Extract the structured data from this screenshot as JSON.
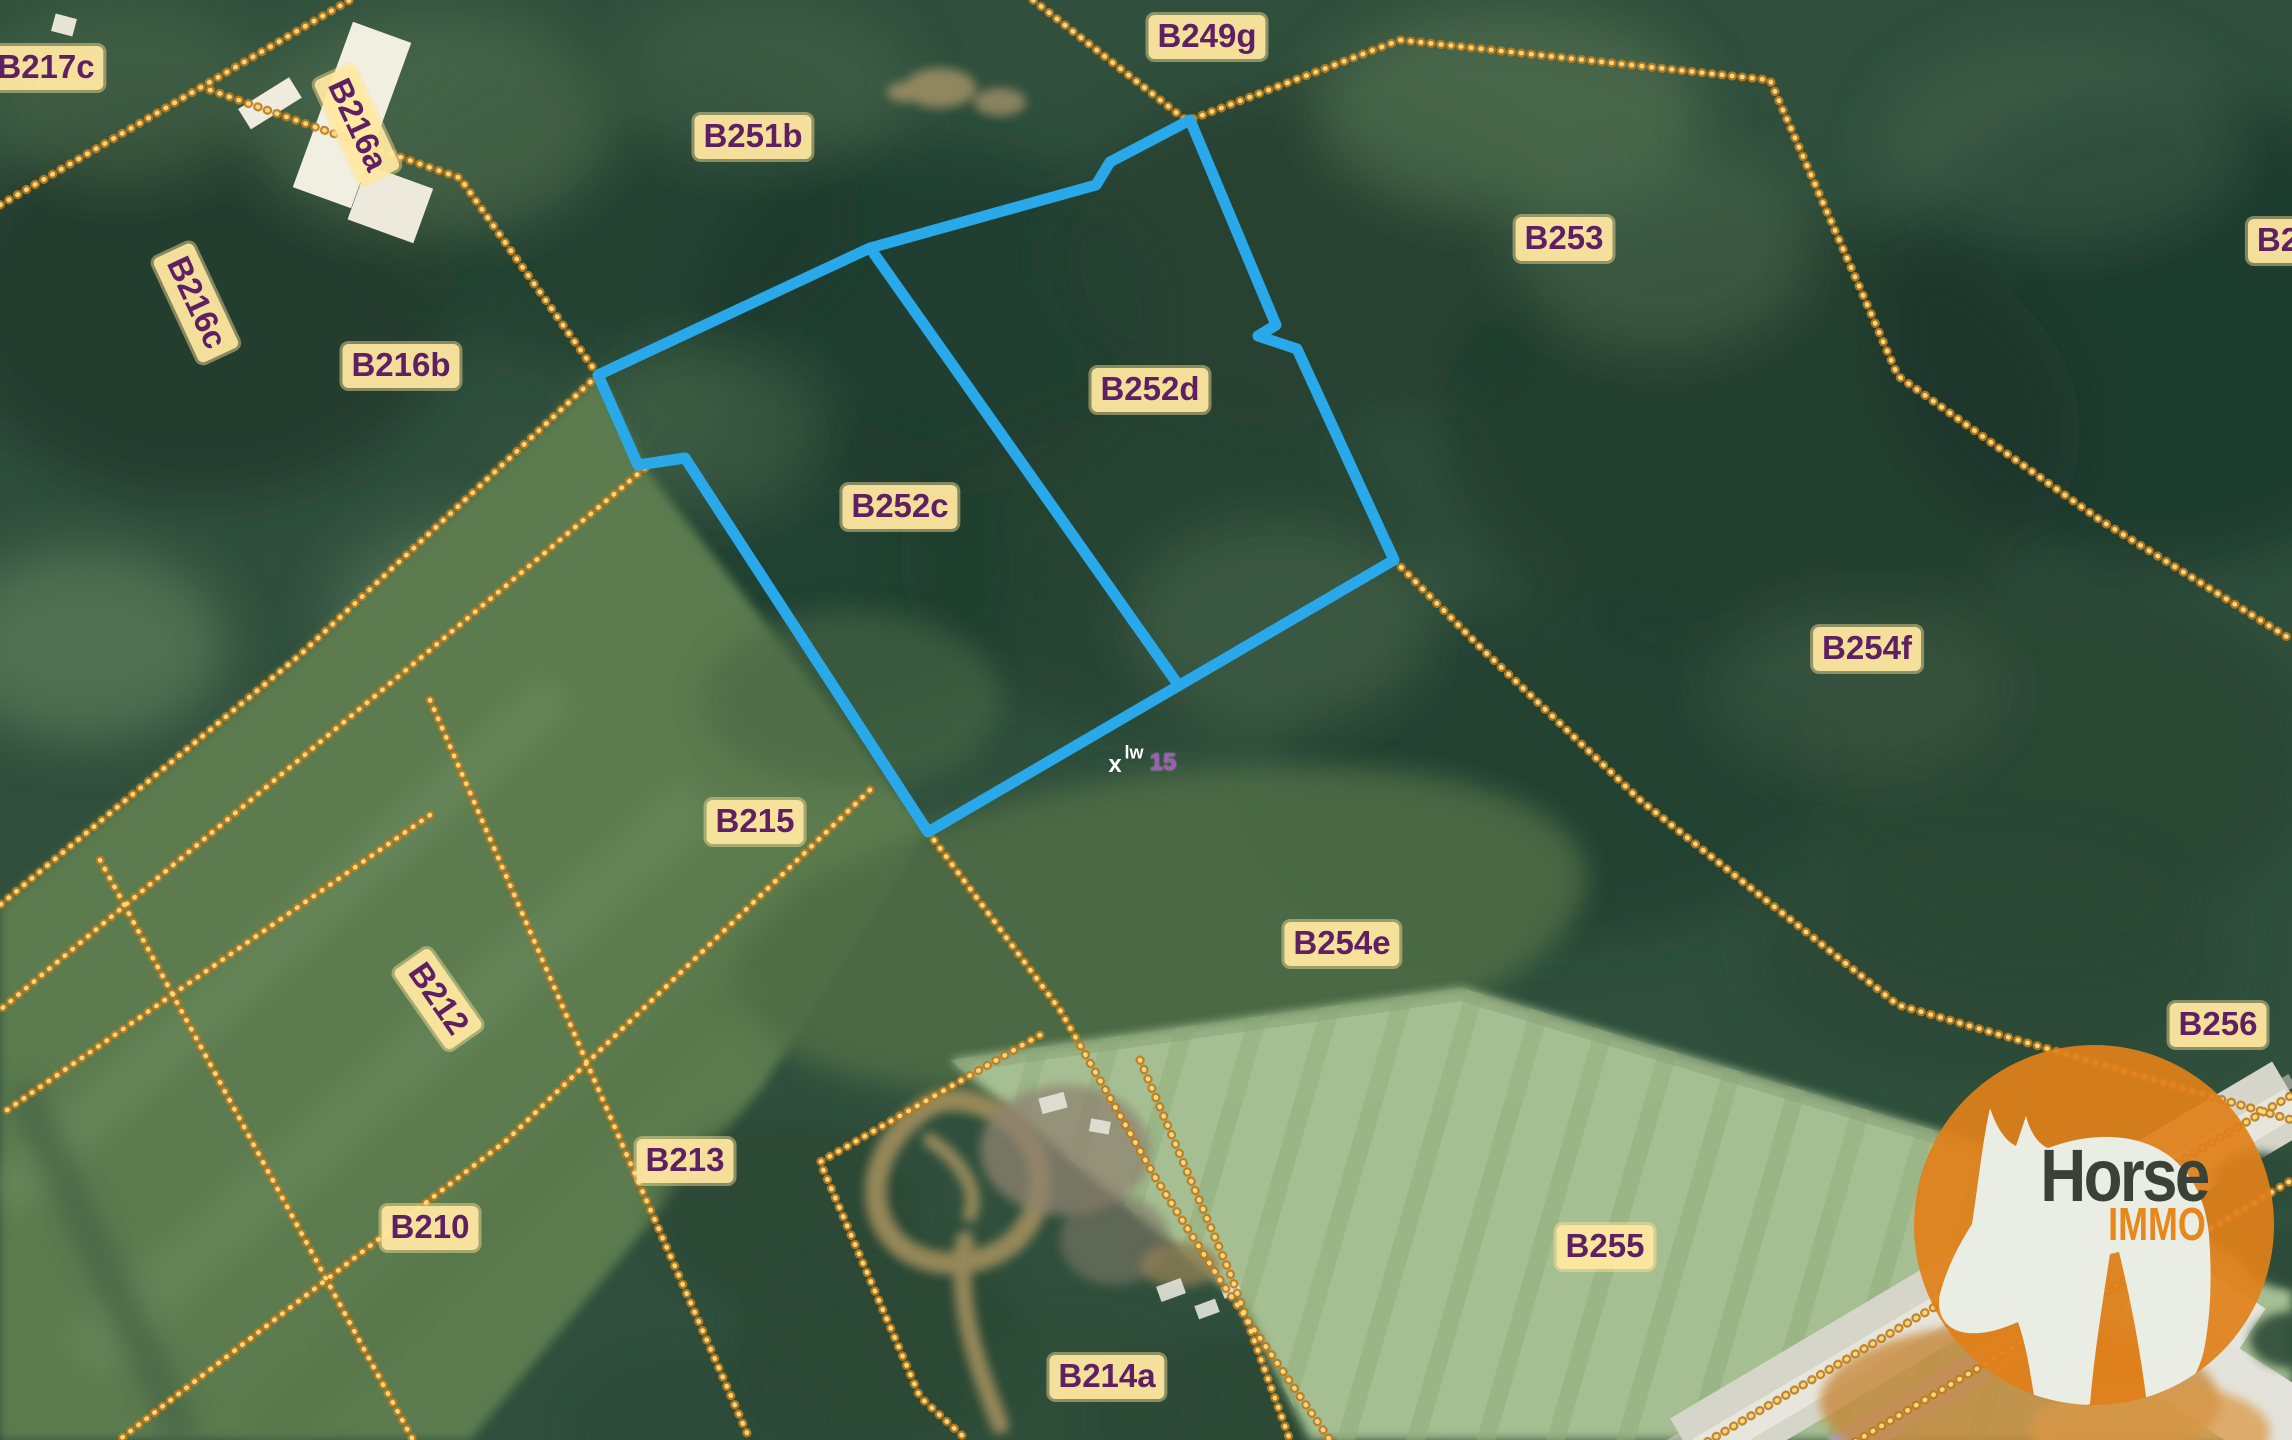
{
  "map": {
    "parcels": [
      {
        "id": "B217c"
      },
      {
        "id": "B216a"
      },
      {
        "id": "B216c"
      },
      {
        "id": "B216b"
      },
      {
        "id": "B251b"
      },
      {
        "id": "B249g"
      },
      {
        "id": "B253"
      },
      {
        "id": "B2"
      },
      {
        "id": "B252d"
      },
      {
        "id": "B252c"
      },
      {
        "id": "B254f"
      },
      {
        "id": "B215"
      },
      {
        "id": "B254e"
      },
      {
        "id": "B212"
      },
      {
        "id": "B213"
      },
      {
        "id": "B210"
      },
      {
        "id": "B255"
      },
      {
        "id": "B256"
      },
      {
        "id": "B214a"
      }
    ],
    "highlighted_parcels": "B252c, B252d",
    "survey_marks": {
      "mark_x": "x",
      "mark_lw": "lw",
      "mark_15": "15"
    },
    "colors": {
      "highlight_outline": "#29A9EA",
      "boundary_dots": "#F0A83C",
      "label_background": "#FFE8A0",
      "label_text": "#5E2063"
    }
  },
  "logo": {
    "brand": "Horse",
    "sub_brand": "IMMO",
    "circle_color": "#E0801A",
    "brand_color": "#3A4238",
    "sub_color": "#E8871C"
  }
}
